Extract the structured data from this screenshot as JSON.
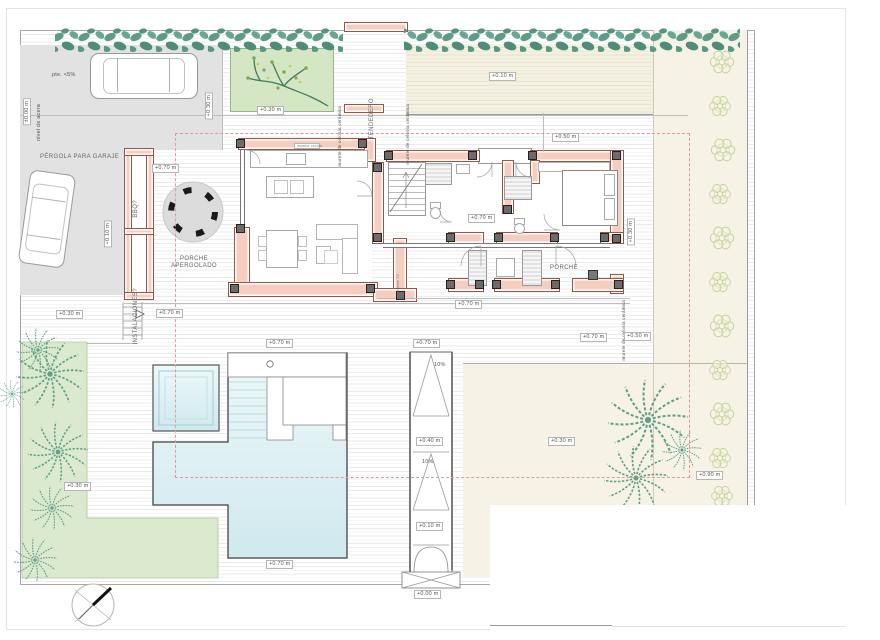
{
  "t": {
    "pergola": "PÉRGOLA PARA GARAJE",
    "pte": "pte. <5%",
    "nivel": "nivel de acera",
    "tend": "TENDEDERO",
    "murete": "murete de celosía cerámica",
    "bbq": "BBQ?",
    "inst": "INSTALACIONES?",
    "porche1": "PORCHE",
    "porche2": "APERGOLADO",
    "porche": "PORCHE",
    "mtv": "mueble TV",
    "mcoc": "mueble cocina"
  },
  "lv": {
    "acera": "±0.00 m",
    "l000": "+0.00 m",
    "l010": "+0.10 m",
    "l030": "+0.30 m",
    "l040": "+0.40 m",
    "l050": "+0.50 m",
    "l070": "+0.70 m",
    "l090": "+0.90 m",
    "slope": "10%"
  },
  "colors": {
    "wall": "#f6cec0",
    "wall_edge": "#9c5441",
    "pool": "#d9edf1",
    "lawn": "#dbe9ce",
    "driveway": "#e2e2e2",
    "garden_beige": "#f4f0e2",
    "hedge_green": "#559383",
    "bush_outline": "#c6d49e",
    "setback_dash": "#e09a9a"
  }
}
